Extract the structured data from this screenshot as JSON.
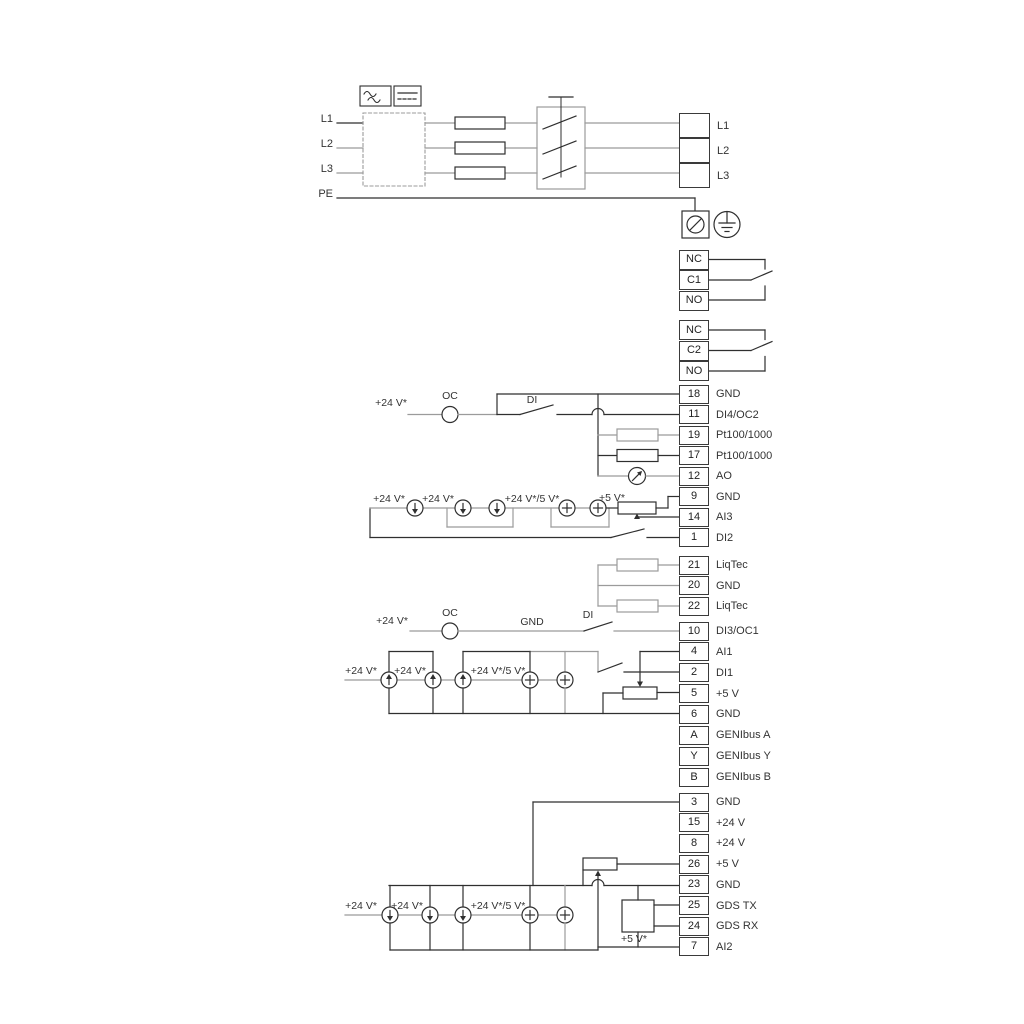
{
  "diagram": {
    "title": "pump-wiring-diagram",
    "power_in": [
      {
        "label": "L1"
      },
      {
        "label": "L2"
      },
      {
        "label": "L3"
      },
      {
        "label": "PE"
      }
    ],
    "power_out": [
      {
        "label": "L1"
      },
      {
        "label": "L2"
      },
      {
        "label": "L3"
      }
    ],
    "relay1": [
      {
        "n": "NC"
      },
      {
        "n": "C1"
      },
      {
        "n": "NO"
      }
    ],
    "relay2": [
      {
        "n": "NC"
      },
      {
        "n": "C2"
      },
      {
        "n": "NO"
      }
    ],
    "io1": [
      {
        "n": "18",
        "label": "GND"
      },
      {
        "n": "11",
        "label": "DI4/OC2"
      },
      {
        "n": "19",
        "label": "Pt100/1000"
      },
      {
        "n": "17",
        "label": "Pt100/1000"
      },
      {
        "n": "12",
        "label": "AO"
      },
      {
        "n": "9",
        "label": "GND"
      },
      {
        "n": "14",
        "label": "AI3"
      },
      {
        "n": "1",
        "label": "DI2"
      }
    ],
    "liqtec": [
      {
        "n": "21",
        "label": "LiqTec"
      },
      {
        "n": "20",
        "label": "GND"
      },
      {
        "n": "22",
        "label": "LiqTec"
      }
    ],
    "io2": [
      {
        "n": "10",
        "label": "DI3/OC1"
      },
      {
        "n": "4",
        "label": "AI1"
      },
      {
        "n": "2",
        "label": "DI1"
      },
      {
        "n": "5",
        "label": "+5 V"
      },
      {
        "n": "6",
        "label": "GND"
      },
      {
        "n": "A",
        "label": "GENIbus A"
      },
      {
        "n": "Y",
        "label": "GENIbus Y"
      },
      {
        "n": "B",
        "label": "GENIbus B"
      }
    ],
    "io3": [
      {
        "n": "3",
        "label": "GND"
      },
      {
        "n": "15",
        "label": "+24 V"
      },
      {
        "n": "8",
        "label": "+24 V"
      },
      {
        "n": "26",
        "label": "+5 V"
      },
      {
        "n": "23",
        "label": "GND"
      },
      {
        "n": "25",
        "label": "GDS TX"
      },
      {
        "n": "24",
        "label": "GDS RX"
      },
      {
        "n": "7",
        "label": "AI2"
      }
    ],
    "labels": {
      "plus24": "+24 V*",
      "plus24or5": "+24 V*/5 V*",
      "plus5": "+5 V*",
      "oc": "OC",
      "di": "DI",
      "gnd": "GND"
    },
    "colors": {
      "wire_dark": "#2f2f2f",
      "wire_gray": "#9b9b9b"
    }
  }
}
